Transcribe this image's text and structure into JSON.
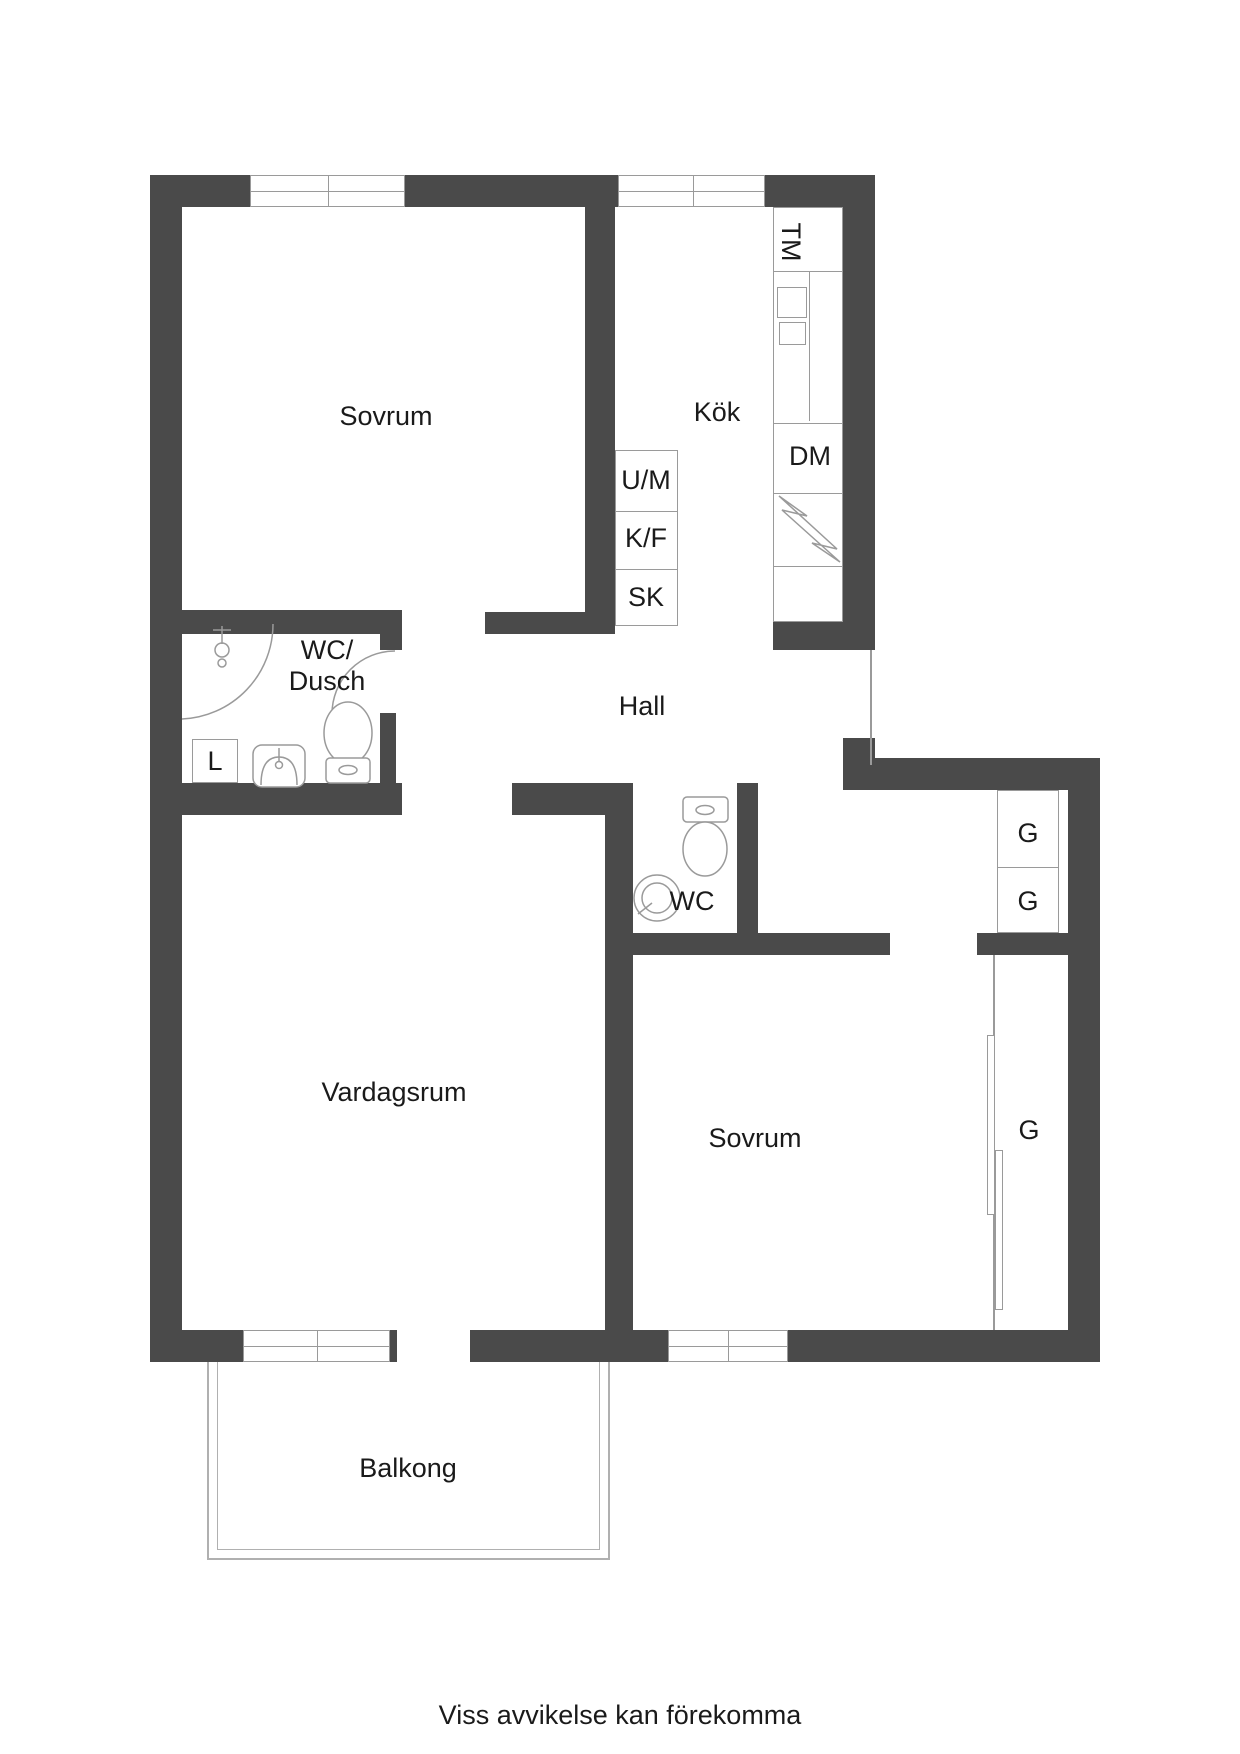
{
  "colors": {
    "wall": "#4a4a4a",
    "fixture_outline": "#9a9a9a",
    "text": "#1a1a1a",
    "background": "#ffffff"
  },
  "rooms": {
    "bedroom1": {
      "label": "Sovrum"
    },
    "kitchen": {
      "label": "Kök"
    },
    "hall": {
      "label": "Hall"
    },
    "bathroom": {
      "label_line1": "WC/",
      "label_line2": "Dusch"
    },
    "toilet": {
      "label": "WC"
    },
    "living_room": {
      "label": "Vardagsrum"
    },
    "bedroom2": {
      "label": "Sovrum"
    },
    "balcony": {
      "label": "Balkong"
    }
  },
  "fixtures": {
    "washing_machine": "TM",
    "dishwasher": "DM",
    "oven_microwave": "U/M",
    "fridge_freezer": "K/F",
    "tall_cabinet": "SK",
    "linen_cabinet": "L",
    "wardrobe1": "G",
    "wardrobe2": "G",
    "wardrobe3": "G"
  },
  "footer": {
    "disclaimer": "Viss avvikelse kan förekomma"
  }
}
